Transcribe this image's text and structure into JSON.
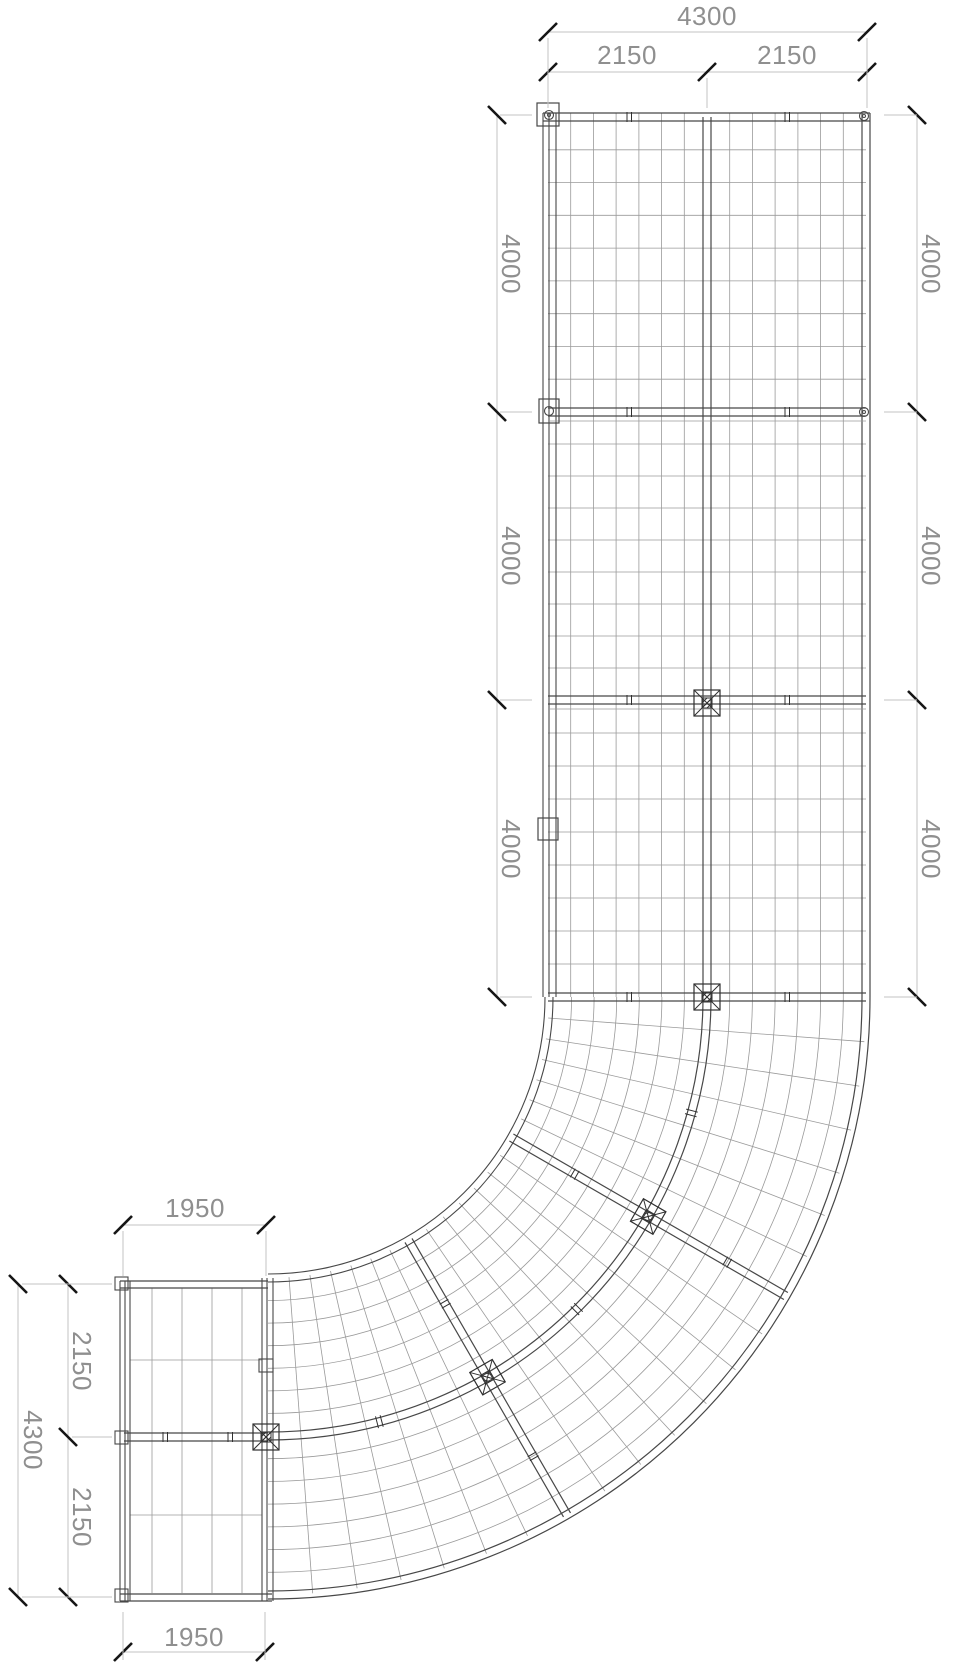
{
  "dimensions": {
    "top": {
      "total": "4300",
      "segments": [
        "2150",
        "2150"
      ]
    },
    "left": [
      "4000",
      "4000",
      "4000"
    ],
    "right": [
      "4000",
      "4000",
      "4000"
    ],
    "annex": {
      "top": "1950",
      "bottom": "1950",
      "left_total": "4300",
      "left_segments": [
        "2150",
        "2150"
      ]
    }
  },
  "colors": {
    "background": "#ffffff",
    "beam": "#474747",
    "grid_line": "#9a9a9a",
    "dim_line": "#c3c3c3",
    "dim_text": "#8f8f8f",
    "tick": "#161616",
    "node": "#303030"
  }
}
